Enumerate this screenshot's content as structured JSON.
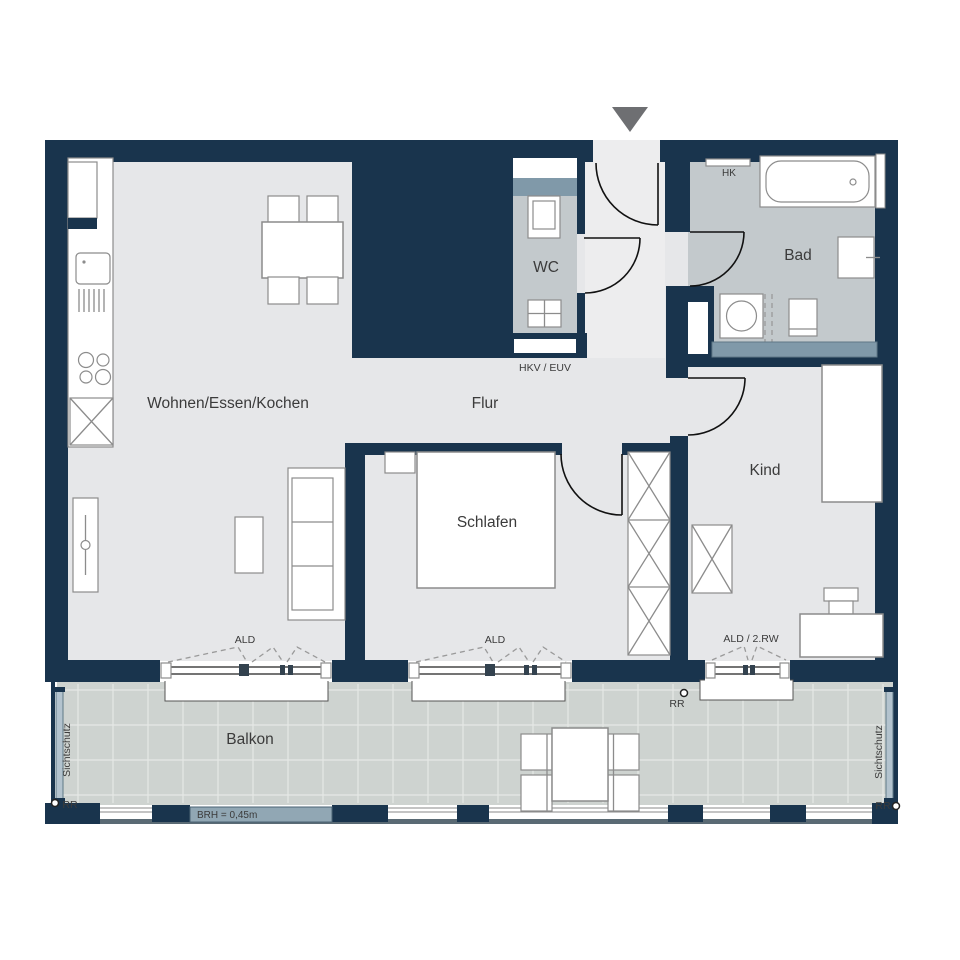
{
  "rooms": {
    "living": "Wohnen/Essen/Kochen",
    "hall": "Flur",
    "wc": "WC",
    "bath": "Bad",
    "bedroom": "Schlafen",
    "child": "Kind",
    "balcony": "Balkon"
  },
  "labels": {
    "radiator": "HK",
    "heating_distributor": "HKV / EUV",
    "vent_living": "ALD",
    "vent_bedroom": "ALD",
    "vent_child": "ALD / 2.RW",
    "rain_pipe_top": "RR",
    "rain_pipe_left": "RR",
    "rain_pipe_right": "RR",
    "privacy_left": "Sichtschutz",
    "privacy_right": "Sichtschutz",
    "parapet_height": "BRH = 0,45m"
  },
  "colors": {
    "wall": "#19344d",
    "floor": "#e6e7e9",
    "corridor_floor": "#ededee",
    "wet_room_floor": "#c3c9cc",
    "balcony_tile": "#ced3d0",
    "accent_slate": "#8099a9",
    "parapet_bar": "#91a7b4",
    "privacy_glass": "#b3c3ce",
    "entry_arrow": "#6e6f72"
  }
}
